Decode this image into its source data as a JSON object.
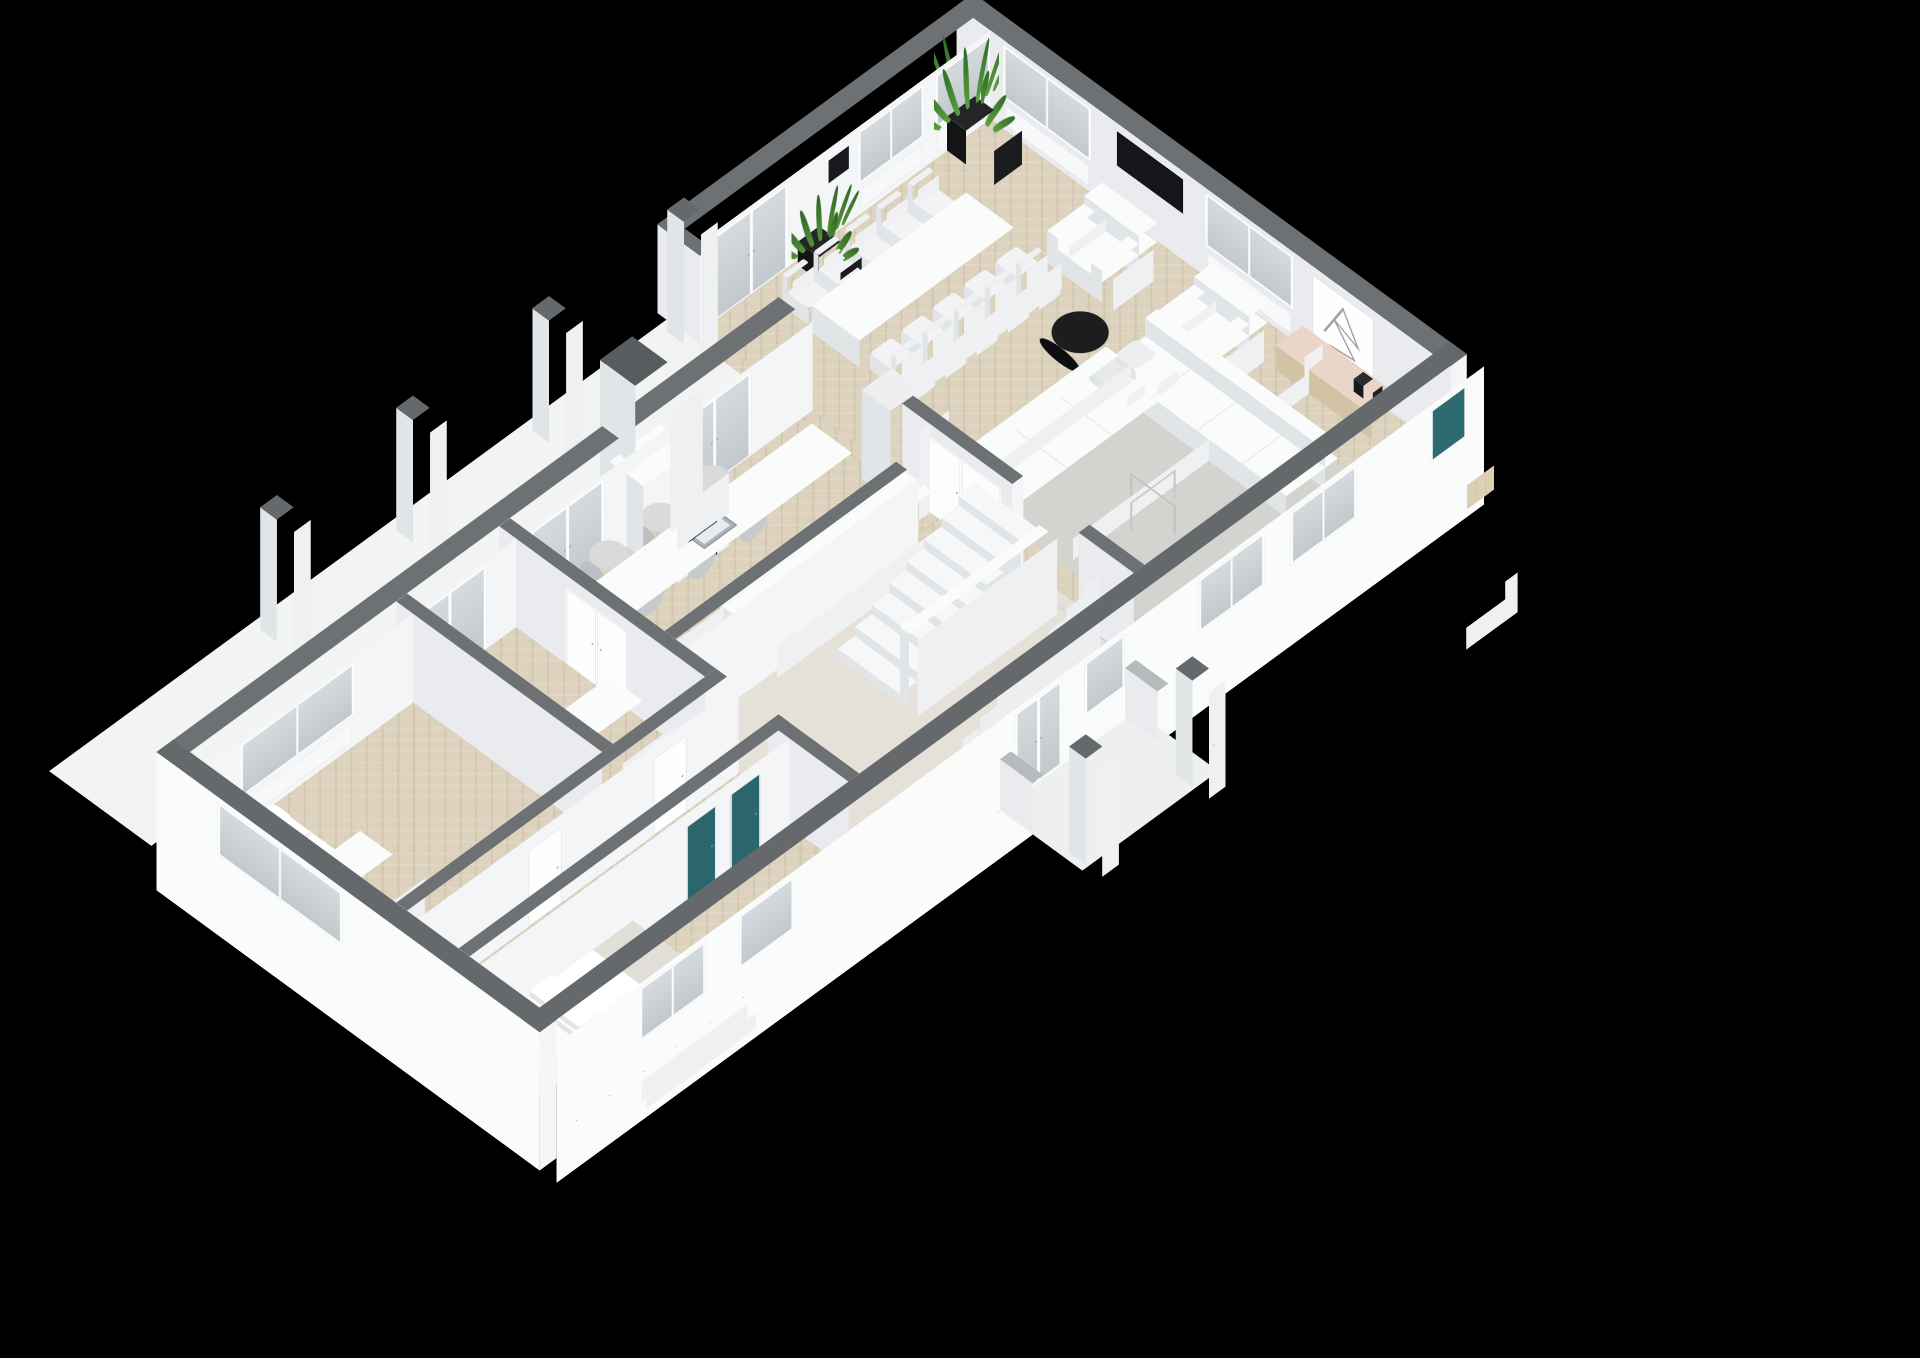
{
  "app": {
    "type": "3d-floorplan-render",
    "background": "#000000"
  },
  "scene": {
    "canvas_w": 1920,
    "canvas_h": 1358,
    "tx": 80,
    "ty": 760,
    "tilt_deg": 43,
    "turn_deg": -45,
    "scale": 0.52,
    "wall_h": 250,
    "colors": {
      "wallTopExt": "#66696b",
      "wallTopInt": "#6e7173",
      "faceBright": "#f4f5f6",
      "faceShade": "#e9ebee",
      "extFace": "#fafbfb",
      "glassTeal": "#2e6b71",
      "navy": "#16324d",
      "floorBeige": "#dcd2bd",
      "floorHall": "#e6e1d8",
      "deck": "#f2f3f3",
      "porchSlab": "#eef0f0",
      "rug": "#d3d3d0",
      "boxTop": "#fafbfb",
      "boxSy": "#eef0f2",
      "boxSx": "#e2e5e7",
      "dark": "#17191b",
      "wood": "#eadfc9",
      "woodSy": "#ddcfb2",
      "woodSx": "#d2c3a4",
      "pillowTop": "#ffffff",
      "chimneyTop": "#595c5e",
      "stubTop": "#b6babc"
    },
    "rooms": [
      "living-room",
      "dining-area",
      "kitchen",
      "stair-hallway",
      "corridor",
      "bedroom",
      "master-bedroom",
      "bathroom",
      "terrace",
      "entrance-porch"
    ]
  },
  "walls": [
    {
      "name": "nw-wing-facade",
      "dir": "x",
      "x": -46,
      "y": 254,
      "len": 1692,
      "th": 46,
      "int": true,
      "openings": [
        {
          "t": "win",
          "u": 136,
          "w": 310
        },
        {
          "t": "gdoor",
          "u": 606,
          "w": 200
        },
        {
          "t": "gdoor",
          "u": 926,
          "w": 200
        },
        {
          "t": "gdoor",
          "u": 1326,
          "w": 200
        }
      ]
    },
    {
      "name": "facade-step-return",
      "dir": "y",
      "x": 1616,
      "y": -46,
      "len": 116,
      "th": 30,
      "int": true,
      "caps": "e"
    },
    {
      "name": "nw-living-facade",
      "dir": "x",
      "x": 1646,
      "y": -46,
      "len": 830,
      "th": 46,
      "int": true,
      "openings": [
        {
          "t": "gdoor",
          "u": 34,
          "w": 200
        },
        {
          "t": "black",
          "u": 344,
          "w": 55
        },
        {
          "t": "win",
          "u": 424,
          "w": 180
        },
        {
          "t": "win",
          "u": 634,
          "w": 150
        }
      ]
    },
    {
      "name": "ne-end-wall",
      "dir": "y",
      "x": 2430,
      "y": -46,
      "len": 1342,
      "th": 46,
      "int": true,
      "caps": "e",
      "capDrop": 140,
      "openings": [
        {
          "t": "win",
          "u": 126,
          "w": 240
        },
        {
          "t": "tv",
          "u": 436,
          "w": 180
        },
        {
          "t": "win",
          "u": 676,
          "w": 240
        },
        {
          "t": "art",
          "u": 966,
          "w": 170
        }
      ]
    },
    {
      "name": "se-facade",
      "dir": "x",
      "x": -46,
      "y": 1250,
      "len": 2522,
      "th": 46,
      "ext": true,
      "drop": 140,
      "caps": "s",
      "capDrop": 140,
      "openings": [
        {
          "t": "win",
          "u": 226,
          "w": 180
        },
        {
          "t": "win",
          "u": 496,
          "w": 150
        },
        {
          "t": "gdoor",
          "u": 1246,
          "w": 130
        },
        {
          "t": "win",
          "u": 1436,
          "w": 110
        },
        {
          "t": "win",
          "u": 1746,
          "w": 180
        },
        {
          "t": "win",
          "u": 1996,
          "w": 180
        },
        {
          "t": "tealwin",
          "u": 2376,
          "w": 100
        }
      ]
    },
    {
      "name": "sw-end-wall",
      "dir": "y",
      "x": -46,
      "y": 254,
      "len": 1042,
      "th": 46,
      "ext": true,
      "drop": 140,
      "caps": "e",
      "capDrop": 140,
      "openings": [
        {
          "t": "win",
          "u": 166,
          "w": 340
        }
      ]
    },
    {
      "name": "wing-kitchen-wall-a",
      "dir": "y",
      "x": 840,
      "y": 300,
      "len": 560,
      "th": 30,
      "caps": "e",
      "openings": [
        {
          "t": "ddoor",
          "u": 180,
          "w": 170
        }
      ]
    },
    {
      "name": "wing-kitchen-wall-b",
      "dir": "y",
      "x": 840,
      "y": 1030,
      "len": 220,
      "th": 30
    },
    {
      "name": "bedroom-bath-divider",
      "dir": "y",
      "x": 560,
      "y": 300,
      "len": 560,
      "th": 30
    },
    {
      "name": "corridor-north-wall",
      "dir": "x",
      "x": 0,
      "y": 860,
      "len": 870,
      "th": 30,
      "openings": [
        {
          "t": "door",
          "u": 300,
          "w": 90
        },
        {
          "t": "door",
          "u": 640,
          "w": 90
        }
      ]
    },
    {
      "name": "master-bedroom-wall",
      "dir": "x",
      "x": 0,
      "y": 1030,
      "len": 870,
      "th": 30,
      "openings": [
        {
          "t": "teal",
          "u": 560,
          "w": 80
        },
        {
          "t": "teal",
          "u": 680,
          "w": 80
        }
      ]
    },
    {
      "name": "kitchen-hall-wall",
      "dir": "x",
      "x": 870,
      "y": 720,
      "len": 630,
      "th": 30
    },
    {
      "name": "hall-living-wall-a",
      "dir": "y",
      "x": 1616,
      "y": 620,
      "len": 300,
      "th": 30,
      "caps": "e",
      "openings": [
        {
          "t": "ddoor",
          "u": 50,
          "w": 220
        }
      ]
    },
    {
      "name": "hall-living-wall-b",
      "dir": "y",
      "x": 1616,
      "y": 1100,
      "len": 150,
      "th": 30
    },
    {
      "name": "porch-stub-1",
      "dir": "y",
      "x": 1160,
      "y": 1296,
      "len": 134,
      "th": 30,
      "topZ": 140,
      "stub": true
    },
    {
      "name": "porch-stub-2",
      "dir": "y",
      "x": 1500,
      "y": 1296,
      "len": 134,
      "th": 30,
      "topZ": 140,
      "stub": true
    }
  ],
  "floors": [
    {
      "name": "terrace-deck",
      "x": -60,
      "y": -24,
      "w": 1700,
      "d": 278,
      "cls": "deckfloor",
      "z": -4
    },
    {
      "name": "porch-slab",
      "x": 1160,
      "y": 1296,
      "w": 370,
      "d": 270,
      "c": "#eef0f0",
      "z": -4
    },
    {
      "name": "floor-bedroom",
      "x": 0,
      "y": 300,
      "w": 560,
      "d": 560,
      "cls": "parquet"
    },
    {
      "name": "floor-bathroom",
      "x": 590,
      "y": 300,
      "w": 250,
      "d": 560,
      "cls": "parquet"
    },
    {
      "name": "floor-corridor",
      "x": 0,
      "y": 890,
      "w": 840,
      "d": 140,
      "cls": "parquet"
    },
    {
      "name": "floor-master-bedroom",
      "x": 0,
      "y": 1060,
      "w": 840,
      "d": 190,
      "cls": "parquet"
    },
    {
      "name": "floor-kitchen",
      "x": 870,
      "y": 300,
      "w": 746,
      "d": 420,
      "cls": "parquet"
    },
    {
      "name": "floor-hallway",
      "x": 870,
      "y": 750,
      "w": 746,
      "d": 500,
      "cls": "plainfloor"
    },
    {
      "name": "floor-living-room",
      "x": 1646,
      "y": 0,
      "w": 784,
      "d": 1250,
      "cls": "parquet"
    },
    {
      "name": "floor-strip-corridor-arch",
      "x": 840,
      "y": 860,
      "w": 30,
      "d": 170,
      "cls": "parquet"
    },
    {
      "name": "floor-strip-passage",
      "x": 1616,
      "y": 70,
      "w": 30,
      "d": 470,
      "cls": "parquet"
    },
    {
      "name": "floor-strip-hall-living",
      "x": 1616,
      "y": 920,
      "w": 30,
      "d": 180,
      "cls": "plainfloor"
    },
    {
      "name": "floor-strip-kitchen-hall",
      "x": 1500,
      "y": 720,
      "w": 116,
      "d": 30,
      "cls": "parquet"
    },
    {
      "name": "area-rug",
      "x": 1700,
      "y": 660,
      "w": 560,
      "d": 560,
      "c": "#d3d3d0",
      "z": 2
    }
  ],
  "boxes": [
    {
      "name": "terrace-pillar-1",
      "x": 490,
      "y": 0,
      "w": 46,
      "d": 46,
      "h": 345,
      "z0": -4,
      "top": "#66696b"
    },
    {
      "name": "terrace-pillar-2",
      "x": 860,
      "y": 0,
      "w": 46,
      "d": 46,
      "h": 345,
      "z0": -4,
      "top": "#66696b"
    },
    {
      "name": "terrace-pillar-3",
      "x": 1230,
      "y": 0,
      "w": 46,
      "d": 46,
      "h": 345,
      "z0": -4,
      "top": "#66696b"
    },
    {
      "name": "terrace-pillar-4",
      "x": 1597,
      "y": 0,
      "w": 46,
      "d": 46,
      "h": 345,
      "z0": -4,
      "top": "#66696b"
    },
    {
      "name": "porch-pillar-1",
      "x": 1175,
      "y": 1515,
      "w": 45,
      "d": 45,
      "h": 300,
      "z0": -4,
      "top": "#66696b"
    },
    {
      "name": "porch-pillar-2",
      "x": 1465,
      "y": 1515,
      "w": 45,
      "d": 45,
      "h": 300,
      "z0": -4,
      "top": "#66696b"
    },
    {
      "name": "chimney",
      "x": 1166,
      "y": 248,
      "w": 88,
      "d": 96,
      "h": 432,
      "top": "#595c5e"
    },
    {
      "name": "fireplace",
      "x": 1140,
      "y": 300,
      "w": 140,
      "d": 92,
      "h": 205,
      "decal": "navy"
    },
    {
      "name": "passage-jamb",
      "x": 1586,
      "y": 540,
      "w": 82,
      "d": 78,
      "h": 250,
      "top": "#edeff1"
    },
    {
      "name": "kitchen-island",
      "x": 900,
      "y": 430,
      "w": 660,
      "d": 110,
      "h": 92,
      "decal": "sink"
    },
    {
      "name": "kitchen-faucet",
      "x": 1218,
      "y": 444,
      "w": 12,
      "d": 12,
      "h": 28,
      "z0": 92,
      "top": "#b9c0c4",
      "sy": "#a9b0b4",
      "sx": "#9aa1a5"
    },
    {
      "name": "kitchen-counter",
      "x": 1100,
      "y": 640,
      "w": 500,
      "d": 78,
      "h": 90
    },
    {
      "name": "dining-table",
      "x": 1790,
      "y": 200,
      "w": 420,
      "d": 130,
      "h": 76
    },
    {
      "name": "armchair-1-base",
      "x": 2240,
      "y": 390,
      "w": 150,
      "d": 150,
      "h": 58
    },
    {
      "name": "armchair-1-back",
      "x": 2340,
      "y": 390,
      "w": 50,
      "d": 150,
      "h": 112
    },
    {
      "name": "armchair-1-arm-a",
      "x": 2240,
      "y": 390,
      "w": 110,
      "d": 30,
      "h": 90
    },
    {
      "name": "armchair-1-arm-b",
      "x": 2240,
      "y": 510,
      "w": 110,
      "d": 30,
      "h": 90
    },
    {
      "name": "armchair-2-base",
      "x": 2240,
      "y": 690,
      "w": 150,
      "d": 150,
      "h": 58
    },
    {
      "name": "armchair-2-back",
      "x": 2340,
      "y": 690,
      "w": 50,
      "d": 150,
      "h": 112
    },
    {
      "name": "armchair-2-arm-a",
      "x": 2240,
      "y": 690,
      "w": 110,
      "d": 30,
      "h": 90
    },
    {
      "name": "armchair-2-arm-b",
      "x": 2240,
      "y": 810,
      "w": 110,
      "d": 30,
      "h": 90
    },
    {
      "name": "coffee-table-round",
      "x": 2070,
      "y": 540,
      "w": 110,
      "d": 110,
      "h": 46,
      "r": "50%",
      "top": "#1b1d1f",
      "sy": "#111314",
      "sx": "#0c0e0f"
    },
    {
      "name": "sofa-long-base",
      "x": 2090,
      "y": 700,
      "w": 140,
      "d": 490,
      "h": 62,
      "lines": "y"
    },
    {
      "name": "sofa-long-back",
      "x": 2196,
      "y": 700,
      "w": 34,
      "d": 490,
      "h": 112
    },
    {
      "name": "sofa-short-base",
      "x": 1720,
      "y": 700,
      "w": 370,
      "d": 140,
      "h": 62,
      "lines": "x"
    },
    {
      "name": "sofa-short-back",
      "x": 1720,
      "y": 700,
      "w": 370,
      "d": 34,
      "h": 112
    },
    {
      "name": "sofa-pillow-1",
      "x": 2098,
      "y": 716,
      "w": 58,
      "d": 58,
      "h": 34,
      "z0": 62,
      "r": "12px",
      "top": "#eceeef"
    },
    {
      "name": "sofa-pillow-2",
      "x": 2036,
      "y": 706,
      "w": 52,
      "d": 52,
      "h": 30,
      "z0": 62,
      "r": "12px",
      "top": "#e7e9ea"
    },
    {
      "name": "sideboard",
      "x": 2352,
      "y": 900,
      "w": 74,
      "d": 260,
      "h": 68,
      "top": "#ead5c9",
      "sy": "#ddcfb2",
      "sx": "#d2c3a4",
      "decal": "seams"
    },
    {
      "name": "decor-vase",
      "x": 2372,
      "y": 1092,
      "w": 26,
      "d": 26,
      "h": 36,
      "z0": 68,
      "top": "#2a2d2f",
      "sy": "#1e2123",
      "sx": "#17191b"
    },
    {
      "name": "bed-single-base",
      "x": 40,
      "y": 380,
      "w": 106,
      "d": 215,
      "h": 42
    },
    {
      "name": "bed-single-mattress",
      "x": 44,
      "y": 384,
      "w": 98,
      "d": 207,
      "h": 58,
      "r": "8px",
      "top": "#ffffff"
    },
    {
      "name": "bed-single-pillow",
      "x": 50,
      "y": 392,
      "w": 86,
      "d": 50,
      "h": 72,
      "r": "10px",
      "top": "#ffffff"
    },
    {
      "name": "bookshelf",
      "x": 40,
      "y": 630,
      "w": 92,
      "d": 88,
      "h": 178,
      "decal": "books"
    },
    {
      "name": "bathroom-cabinet",
      "x": 596,
      "y": 700,
      "w": 144,
      "d": 90,
      "h": 205
    },
    {
      "name": "bed-double-base",
      "x": 120,
      "y": 1055,
      "w": 300,
      "d": 182,
      "h": 44
    },
    {
      "name": "bed-double-mattress",
      "x": 126,
      "y": 1061,
      "w": 288,
      "d": 170,
      "h": 60,
      "top": "#ffffff",
      "stripe": true
    },
    {
      "name": "bed-double-pillow-1",
      "x": 132,
      "y": 1070,
      "w": 58,
      "d": 74,
      "h": 76,
      "r": "10px",
      "top": "#ffffff"
    },
    {
      "name": "bed-double-pillow-2",
      "x": 132,
      "y": 1152,
      "w": 58,
      "d": 74,
      "h": 76,
      "r": "10px",
      "top": "#ffffff"
    },
    {
      "name": "nightstand-1",
      "x": 52,
      "y": 1062,
      "w": 64,
      "d": 64,
      "h": 52
    },
    {
      "name": "nightstand-2",
      "x": 52,
      "y": 1172,
      "w": 64,
      "d": 64,
      "h": 52
    },
    {
      "name": "stair-stringer",
      "x": 1220,
      "y": 1010,
      "w": 380,
      "d": 24,
      "h": 215
    }
  ],
  "stools": [
    {
      "x": 1010,
      "y": 352
    },
    {
      "x": 1150,
      "y": 352
    },
    {
      "x": 1290,
      "y": 352
    }
  ],
  "stool_size": {
    "w": 76,
    "d": 76,
    "h": 80
  },
  "chair_rows": [
    {
      "name": "dining-chairs-nw",
      "x0": 1800,
      "y": 122,
      "n": 5,
      "dx": 85,
      "w": 58,
      "d": 60,
      "h": 46,
      "back": "-y"
    },
    {
      "name": "dining-chairs-se",
      "x0": 1800,
      "y": 348,
      "n": 5,
      "dx": 85,
      "w": 58,
      "d": 60,
      "h": 46,
      "back": "+y"
    }
  ],
  "stairs": {
    "name": "staircase",
    "x": 1220,
    "y": 840,
    "n": 8,
    "stepD": 47,
    "width": 170,
    "rise": 26
  },
  "plants": [
    {
      "name": "plant-living-corner",
      "x": 2312,
      "y": 22,
      "pot": 76,
      "potH": 96,
      "leafH": 175,
      "spread": 175,
      "c1": "#2f6b28",
      "c2": "#5da23f"
    },
    {
      "name": "plant-kitchen-palm",
      "x": 1896,
      "y": 56,
      "pot": 58,
      "potH": 66,
      "leafH": 135,
      "spread": 150,
      "c1": "#2d6527",
      "c2": "#55953a"
    }
  ],
  "wires": [
    {
      "name": "decor-table-wire",
      "x": 1850,
      "y": 950,
      "w": 112,
      "d": 112,
      "h": 86
    }
  ]
}
